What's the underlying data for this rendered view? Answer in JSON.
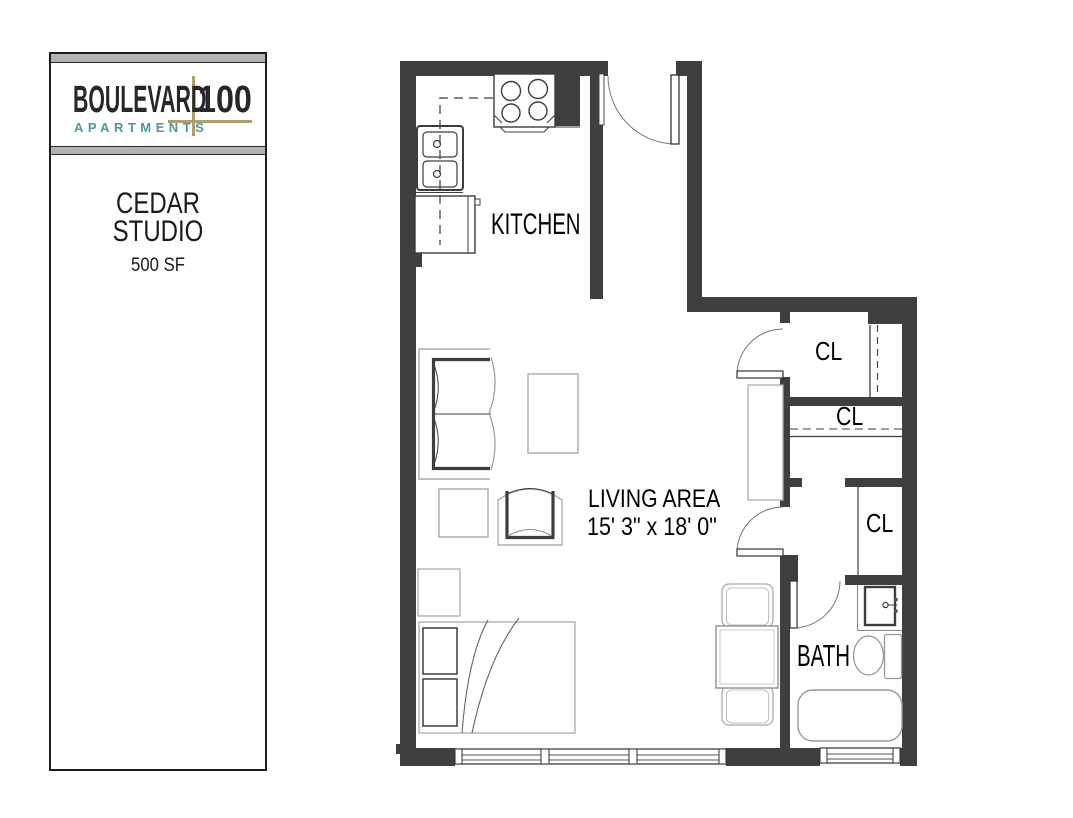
{
  "sidebar": {
    "logo": {
      "brand": "BOULEVARD",
      "number": "100",
      "tagline": "APARTMENTS"
    },
    "unit": {
      "name_line1": "CEDAR",
      "name_line2": "STUDIO",
      "size": "500 SF"
    }
  },
  "floorplan": {
    "labels": {
      "kitchen": "KITCHEN",
      "living_area": "LIVING AREA",
      "living_dimensions": "15' 3\" x 18' 0\"",
      "bath": "BATH",
      "closet": "CL"
    }
  },
  "colors": {
    "wall": "#3f3f3f",
    "logo_text": "#26262b",
    "logo_accent_tan": "#b09f6d",
    "logo_teal": "#4e95a5",
    "strip_gray": "#b3b3b3"
  }
}
